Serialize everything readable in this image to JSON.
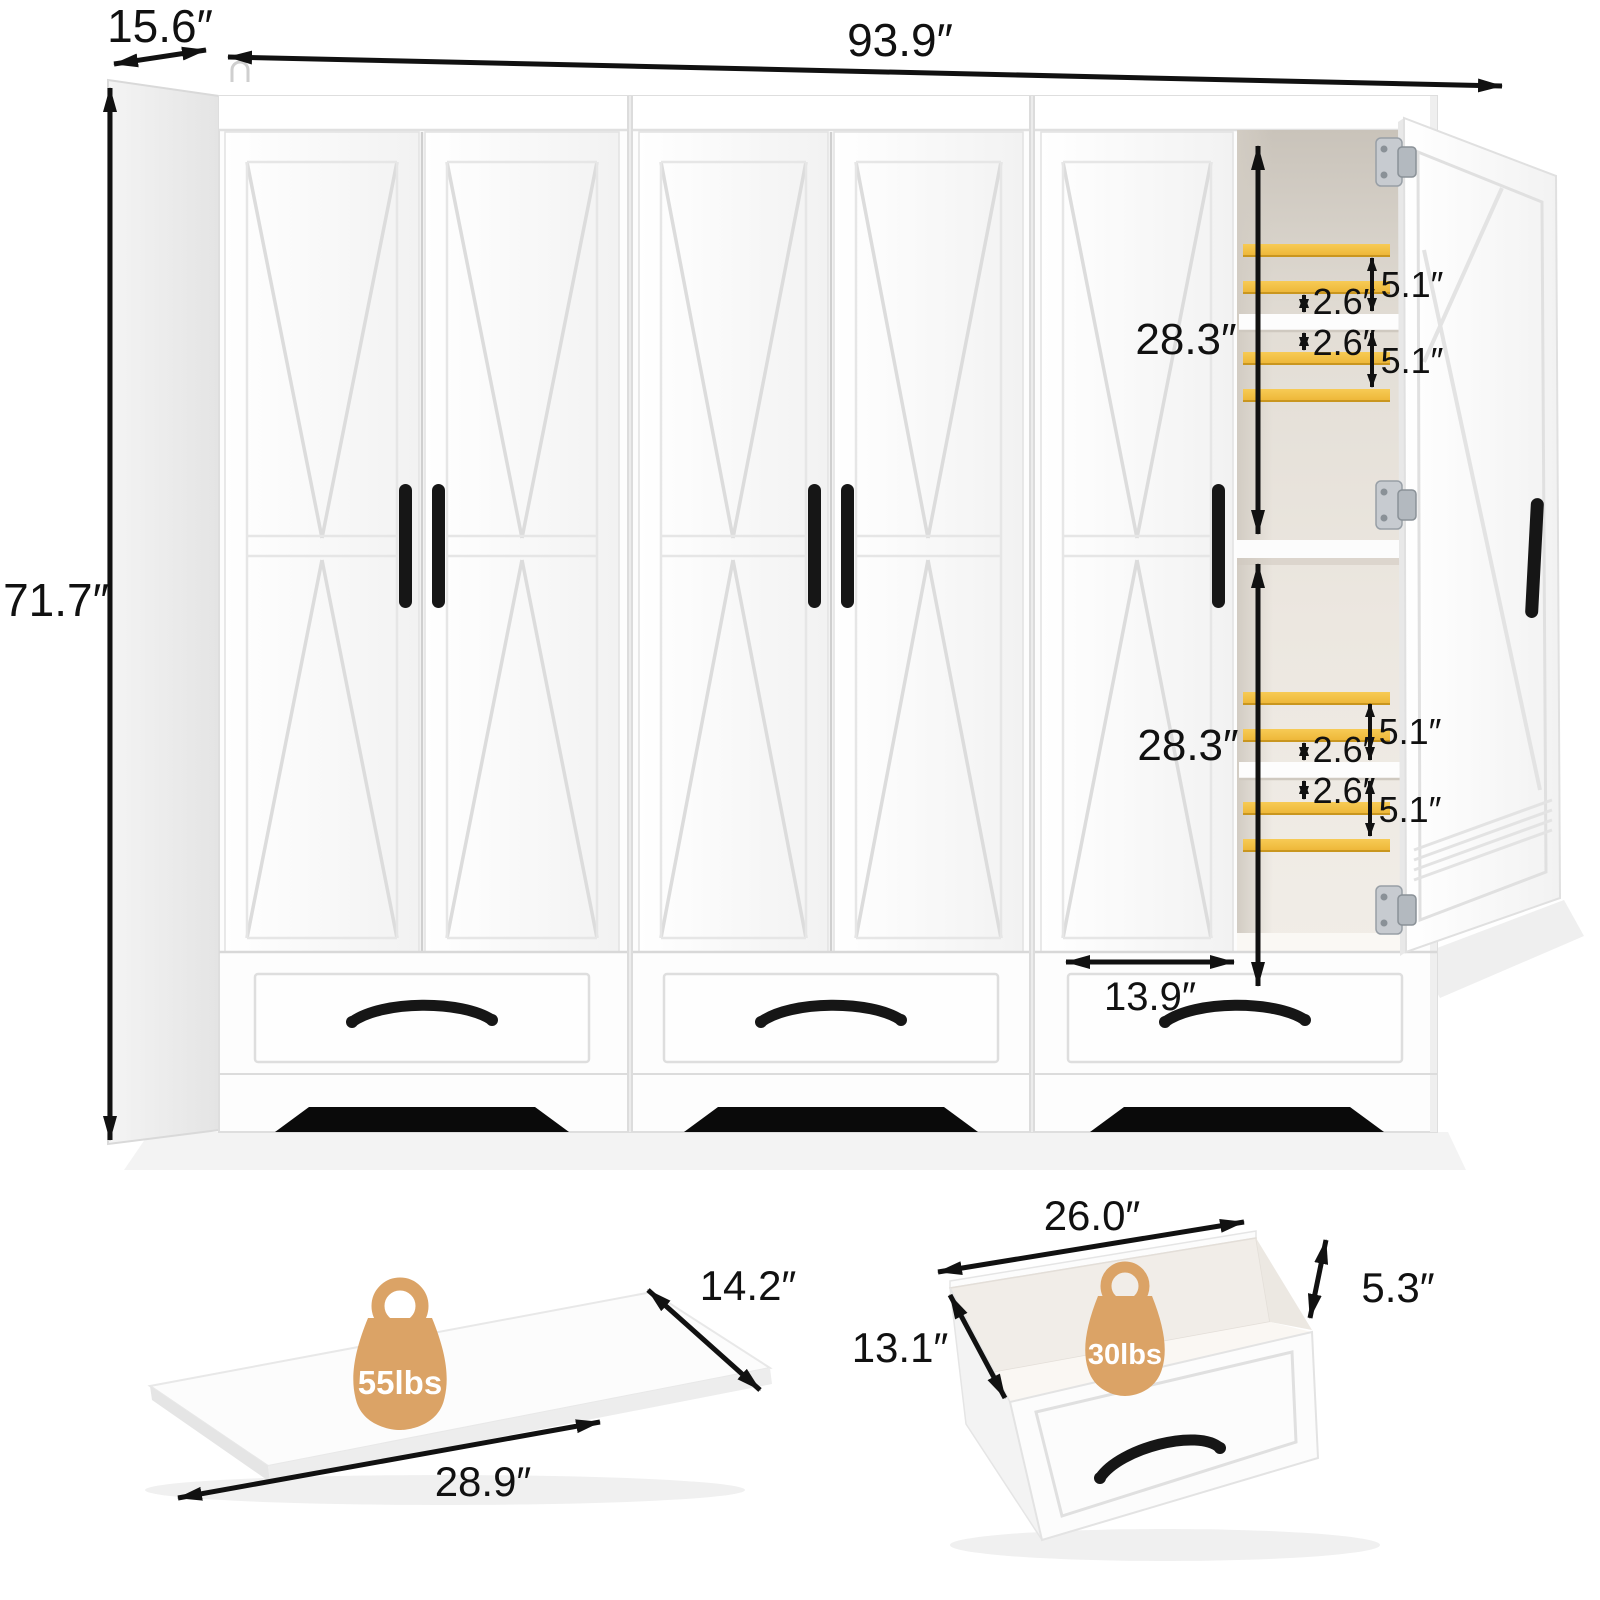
{
  "wardrobe": {
    "overall": {
      "width": "93.9″",
      "depth": "15.6″",
      "height": "71.7″"
    },
    "interior": {
      "upper_section_height": "28.3″",
      "lower_section_height": "28.3″",
      "bay_width": "13.9″",
      "upper_shelf_gaps": [
        "5.1″",
        "2.6″",
        "2.6″",
        "5.1″"
      ],
      "lower_shelf_gaps": [
        "5.1″",
        "2.6″",
        "2.6″",
        "5.1″"
      ]
    }
  },
  "shelf_board": {
    "depth": "14.2″",
    "width": "28.9″",
    "weight_capacity": "55lbs"
  },
  "drawer_box": {
    "width": "26.0″",
    "height": "5.3″",
    "depth": "13.1″",
    "weight_capacity": "30lbs"
  },
  "colors": {
    "slat_wood": "#F2BD45",
    "badge_tan": "#DBA366",
    "hardware_black": "#161616"
  }
}
